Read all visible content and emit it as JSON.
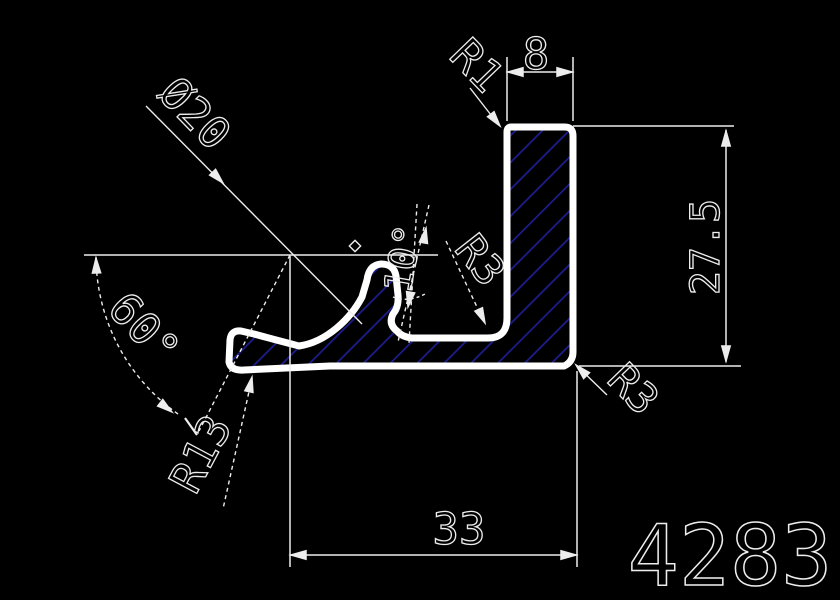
{
  "drawing": {
    "part_number": "4283",
    "colors": {
      "background": "#000000",
      "outline": "#ffffff",
      "lines": "#ededed",
      "hatch": "#1d1d8f"
    },
    "dimensions": {
      "top_width": "8",
      "right_height": "27.5",
      "bottom_width": "33",
      "diameter": "Ø20",
      "angle_left": "60°",
      "angle_hook": "10°",
      "radius_top_left": "R1",
      "radius_inner_fillet": "R3",
      "radius_bottom_right": "R3",
      "radius_left_curve": "R13"
    }
  }
}
